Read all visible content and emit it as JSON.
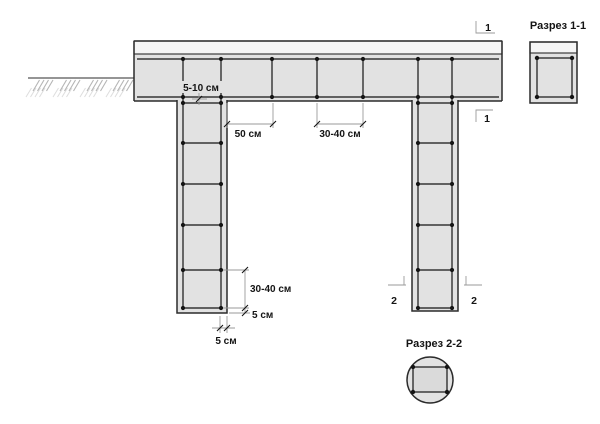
{
  "colors": {
    "background": "#ffffff",
    "concrete_fill": "#e2e2e2",
    "concrete_inner": "#dadada",
    "hatch_background": "#f5f5f5",
    "hatch_line": "#8c8c8c",
    "outline": "#2b2b2b",
    "rebar": "#141414",
    "dimension_line": "#9a9a9a",
    "ground_hatch": "#b5b5b5",
    "text": "#141414"
  },
  "sections": {
    "section_1": {
      "title": "Разрез 1-1"
    },
    "section_2": {
      "title": "Разрез 2-2"
    }
  },
  "dimensions": {
    "rebar_protrusion": "5-10 см",
    "first_stirrup_offset": "50 см",
    "beam_stirrup_spacing": "30-40 см",
    "pile_stirrup_spacing": "30-40 см",
    "pile_bottom_offset": "5 см",
    "pile_side_cover": "5 см"
  },
  "markers": {
    "cut_1_top": "1",
    "cut_1_bottom": "1",
    "cut_2_left": "2",
    "cut_2_right": "2"
  }
}
